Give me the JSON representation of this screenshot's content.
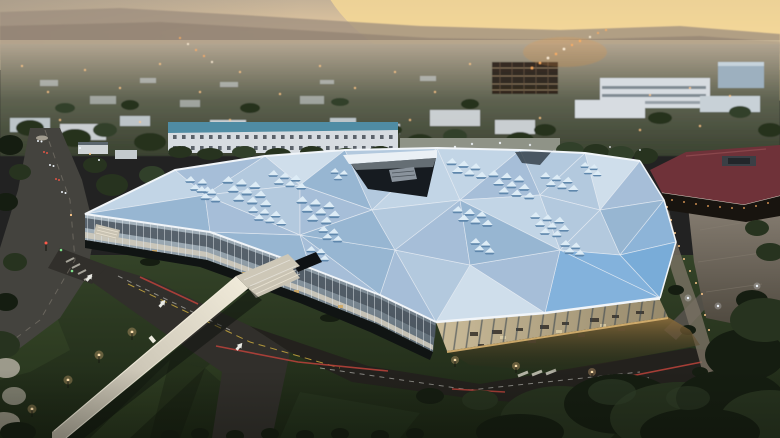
{
  "scene": {
    "type": "aerial-photograph",
    "time_of_day": "dusk",
    "description": "Aerial dusk photograph of a vast low-rise office building with a faceted triangular light-blue roof dotted with clusters of small triangular skylights and a dark roof cutout; warm light glows through slanted glass curtain walls onto the pavement below. A pale pedestrian bridge crosses a dark road over green lawns in the foreground, an expressway with car lights runs along the left, a dark building with a maroon hip roof and a concrete plaza with a bollard-lit path sits at right, and a hazy suburban skyline with distant hills stretches under a peach-orange sunset sky.",
    "features": [
      "sunset haze over distant hills",
      "suburban rooftops, trees and tiny street lights",
      "steel construction frame in midground",
      "triangulated blue roof with skylight clusters",
      "dark roof opening with rooftop unit",
      "glowing glass facades with visible furniture",
      "pedestrian bridge with path lamps",
      "striped dark green lawns",
      "expressway with headlights and traffic signals",
      "maroon-roof building and concrete plaza",
      "bollard-lit walkway",
      "dense dark trees in the foreground"
    ]
  },
  "colors": {
    "sky-top": "#b6a692",
    "sky-mid": "#e3c79f",
    "sky-horizon": "#dcc9a9",
    "sky-glow": "#f6da96",
    "sky-left": "#9d9284",
    "hills-far": "#9c8d7e",
    "hills-near": "#8d7e70",
    "haze": "#d9c7a7",
    "city-top": "#b1a490",
    "city-mid": "#5e6250",
    "city-bottom": "#3a4230",
    "roof-white-bldg": "#d7dce1",
    "bldg-face": "#c8d1d7",
    "teal-roof": "#4f8ca4",
    "glass-block": "#9db0bf",
    "steel-frame": "#281f17",
    "steel-line": "#9b8568",
    "tree-dark": "#27331f",
    "tree-mid": "#31402a",
    "tree-black": "#151d11",
    "light-warm": "#ffc98a",
    "light-hot": "#ffaf62",
    "light-white": "#eef4fa",
    "expwy": "#44433e",
    "road-main": "#312f2b",
    "asphalt-dark": "#23211d",
    "curb-red": "#b5413a",
    "lane-yellow": "#c9a93e",
    "mark-white": "#e9e9e3",
    "lawn-top": "#344328",
    "lawn-bottom": "#1b2514",
    "lawn-stripe": "#5f7a43",
    "lawn-shadow": "#0d130a",
    "roof1": "#cfdeeb",
    "roof2": "#c2d5e6",
    "roof3": "#b3c9de",
    "roof4": "#a6bed8",
    "roof5": "#97b6d2",
    "roof6": "#8db4d8",
    "roof7": "#83b2dc",
    "roof8": "#79acd8",
    "roof-ridge": "#e8eef4",
    "fascia": "#f1f5f9",
    "sk-top": "#ddecf6",
    "sk-side": "#5f87ac",
    "notch-dark": "#161b20",
    "notch-white": "#eaf0f5",
    "vent-gray": "#8a939c",
    "glassw-top": "#a9b7c1",
    "glassw-bot": "#5d6a74",
    "glassw-dark": "#46505a",
    "glassw-walk": "#cfcabb",
    "lit-cell": "#d2a960",
    "glasss-left": "#cabb99",
    "glasss-right": "#96896b",
    "mullion-s": "#33404c",
    "furniture": "#3b352d",
    "apron": "#8a6c3c",
    "glow-core": "#d9b371",
    "bridge-hi": "#f0ead9",
    "bridge-lo": "#b4ae9f",
    "shadow-dark": "#0c100c",
    "plaza-top": "#8b8276",
    "plaza-bot": "#4f493f",
    "maroon": "#6f3239",
    "maroon-hi": "#8a474c",
    "facade-dark": "#18140f",
    "eave-white": "#d7d1c5",
    "base-shadow": "#101413"
  }
}
